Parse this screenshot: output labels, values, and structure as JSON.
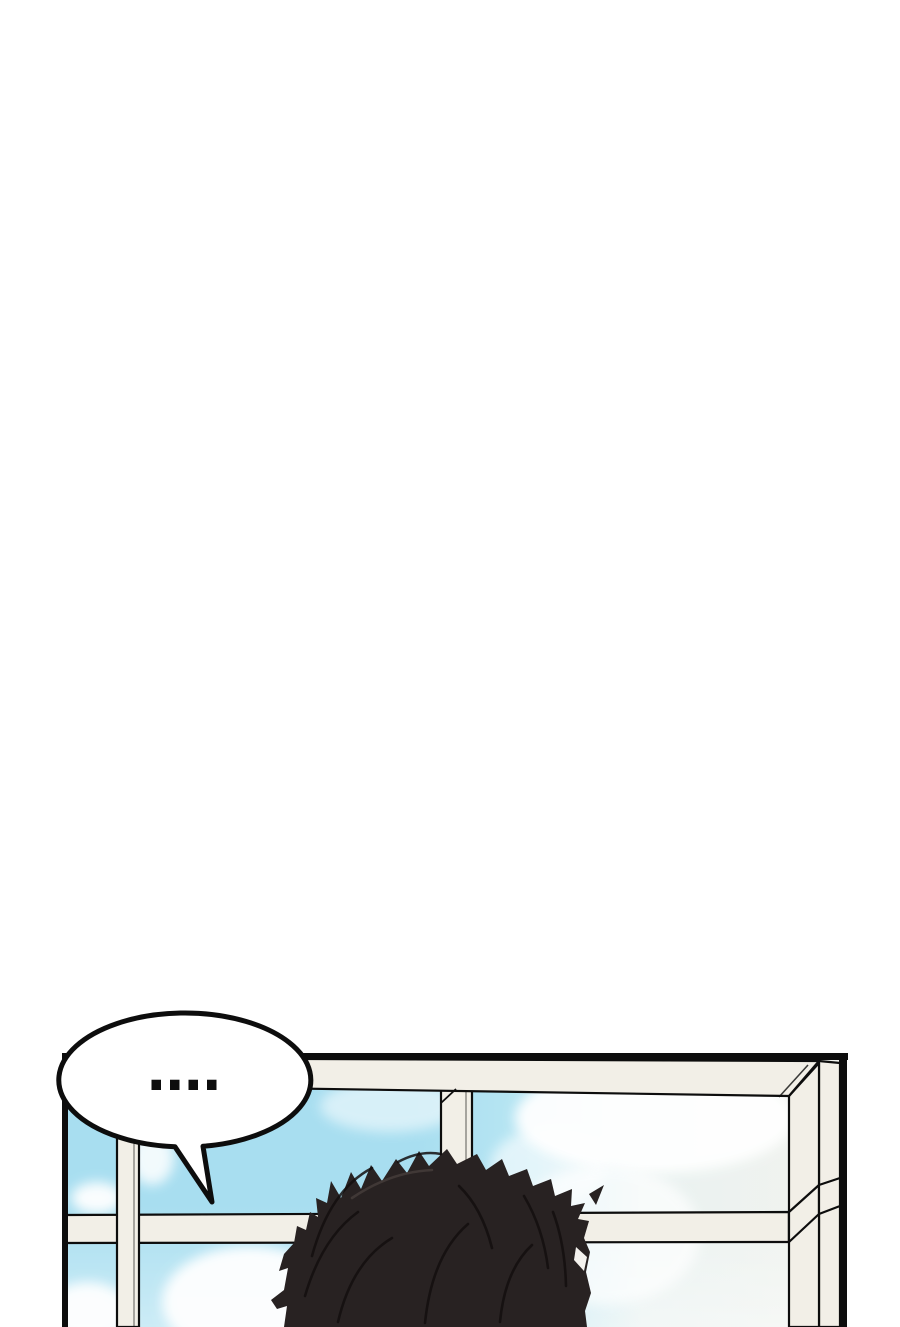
{
  "page": {
    "width": 900,
    "height": 1327,
    "background": "#ffffff"
  },
  "panel": {
    "kind": "manhwa-panel",
    "ink": "#0d0d0d",
    "frame_fill": "#f2efe7",
    "sky_left": "#a8def0",
    "sky_mid": "#b9e6f3",
    "sky_fade": "#e9f2f1",
    "sky_right": "#f2f3ee",
    "cloud": "#ffffff",
    "hair_fill": "#282222",
    "hair_line": "#130f0f",
    "hair_highlight": "#f4f2ee"
  },
  "speech_bubble": {
    "text": "....",
    "fill": "#ffffff",
    "stroke": "#0d0d0d"
  }
}
